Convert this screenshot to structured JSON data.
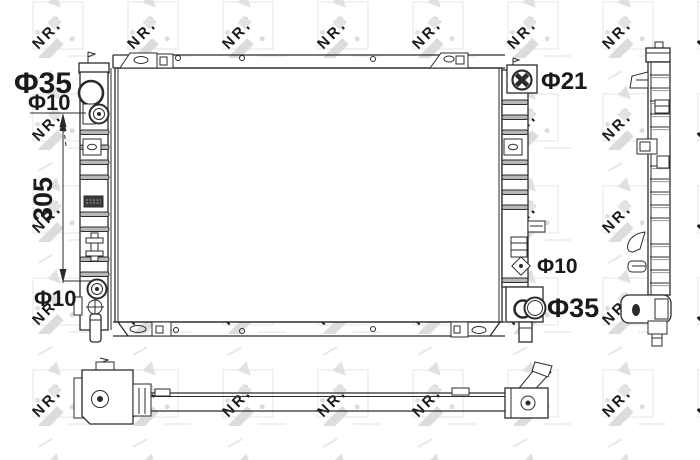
{
  "drawing": {
    "type": "radiator-technical-drawing",
    "brand_watermark": "NRF",
    "dimensions": {
      "left_port_diameter": "Φ35",
      "left_top_fitting_diameter": "Φ10",
      "core_height": "305",
      "left_bottom_fitting_diameter": "Φ10",
      "filler_neck_diameter": "Φ21",
      "right_fitting_diameter": "Φ10",
      "right_port_diameter": "Φ35"
    },
    "colors": {
      "line": "#2b2b2b",
      "watermark": "#e2e2e2",
      "background": "#ffffff"
    }
  }
}
